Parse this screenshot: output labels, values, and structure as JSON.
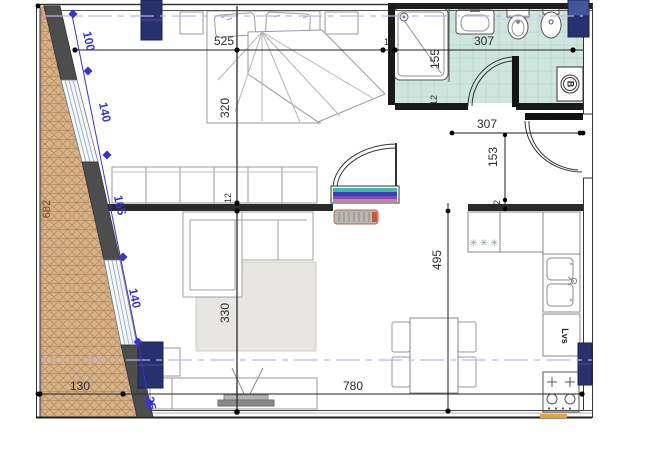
{
  "type": "architectural floor plan (apartment)",
  "dims": {
    "total_height": "682",
    "facade": [
      "100",
      "140",
      "165",
      "140",
      "25"
    ],
    "top_bedroom": "525",
    "top_wall": "12",
    "top_bathroom": "307",
    "bedroom_depth": "320",
    "living_wall": "12",
    "living_depth": "330",
    "shower_width": "155",
    "shower_wall": "12",
    "hall_width": "307",
    "hall_depth": "153",
    "hall_wall": "12",
    "kitchen_run": "495",
    "bottom_left": "130",
    "bottom_main": "780"
  },
  "labels": {
    "boiler": "B",
    "dishwasher": "Lvs",
    "hob_marks": "✳✳✳"
  },
  "colors": {
    "column_navy": "#26316e",
    "column_navy_light": "#46549a",
    "bathroom_floor": "#cfe6df",
    "ground_hatch": "#d6b189",
    "dim_blue": "#3a35c5",
    "section_purple": "#c3b1e1",
    "accent_orange": "#e2a23c",
    "dim_brick": "#8a4430",
    "wall_dark": "#4d4d4d",
    "rug_gray": "#e7e6e2"
  }
}
